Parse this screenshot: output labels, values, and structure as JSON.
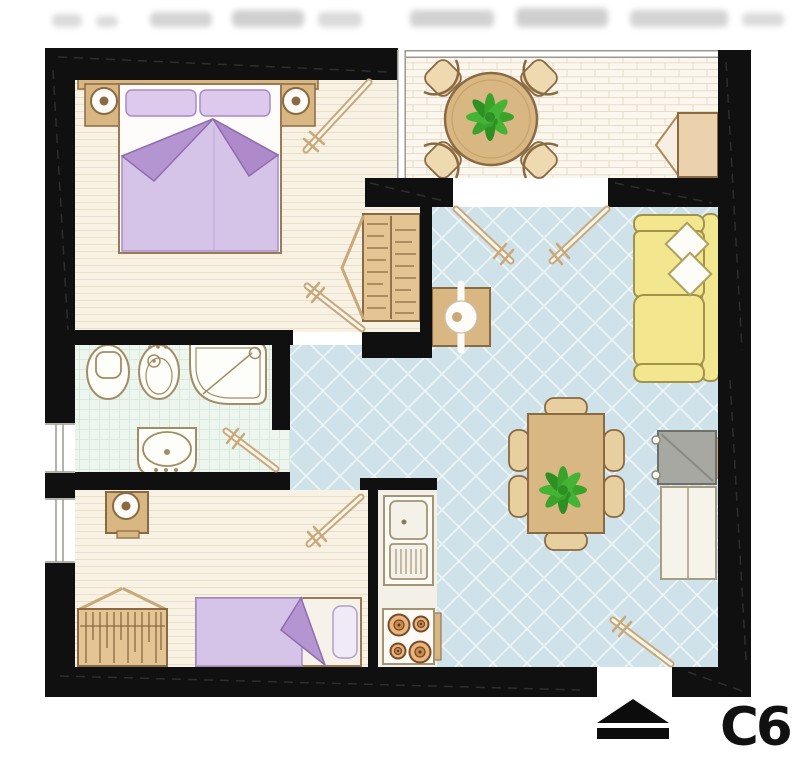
{
  "unit": {
    "label": "C6"
  },
  "plan": {
    "kind": "apartment-floor-plan",
    "entrance_marker": "up-arrow",
    "openings": {
      "left_wall_windows": 2,
      "terrace_french_doors": true,
      "entrance_gap": true
    }
  },
  "rooms": [
    {
      "id": "bedroom-master",
      "furniture": [
        "double-bed",
        "pillows",
        "headboard",
        "nightstand-left",
        "nightstand-right",
        "table-lamp-left",
        "table-lamp-right",
        "wardrobe-open",
        "terrace-door",
        "entry-door"
      ]
    },
    {
      "id": "terrace",
      "furniture": [
        "round-table",
        "potted-plant",
        "chair-nw",
        "chair-ne",
        "chair-sw",
        "chair-se",
        "wall-cabinet-open"
      ]
    },
    {
      "id": "living-room",
      "furniture": [
        "sofa",
        "cushion-1",
        "cushion-2",
        "tv",
        "sideboard",
        "dining-table",
        "potted-plant",
        "dining-chairs-x6",
        "side-table",
        "french-doors",
        "entry-door"
      ]
    },
    {
      "id": "bathroom",
      "furniture": [
        "toilet",
        "bidet",
        "shower",
        "washbasin",
        "door"
      ]
    },
    {
      "id": "bedroom-second",
      "furniture": [
        "single-bed",
        "pillow",
        "desk",
        "desk-lamp",
        "wardrobe-open",
        "door"
      ]
    },
    {
      "id": "kitchen",
      "furniture": [
        "sink-unit",
        "drainer",
        "stove-4-burners",
        "counter"
      ]
    }
  ],
  "colors": {
    "wall": "#101010",
    "wood": "#d9b783",
    "wood_outline": "#8a6a42",
    "door_leaf": "#c9a87a",
    "bedding_light": "#d6c3e8",
    "bedding_dark": "#b495d2",
    "pillow": "#dcc9ec",
    "sofa": "#f2e68e",
    "sofa_outline": "#a3924a",
    "living_floor": "#cfe2ea",
    "bedroom_floor": "#f8f2e5",
    "bathroom_floor": "#edf5ef",
    "terrace_floor": "#fbf7ee",
    "kitchen_floor": "#f3f0e7",
    "plant": "#3aa32c",
    "tv": "#a8a8a2",
    "cabinet": "#f6f3ea",
    "label": "#111111"
  }
}
